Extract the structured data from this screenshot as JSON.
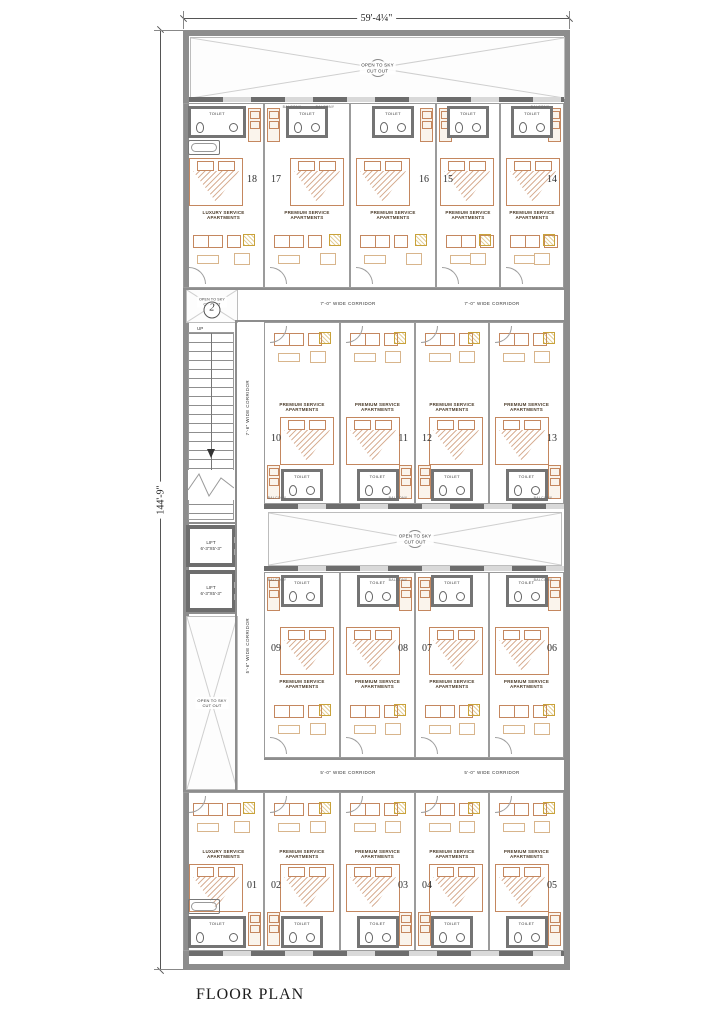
{
  "title": "FLOOR PLAN",
  "dimensions": {
    "width": "59'-4¼\"",
    "height": "144'-9\""
  },
  "labels": {
    "open_to_sky": "OPEN TO SKY",
    "cut_out": "CUT OUT",
    "toilet": "TOILET",
    "balcony": "BALCONY",
    "up": "UP",
    "lift": "LIFT",
    "lift_size": "6'-3\"X5'-3\"",
    "corridor_top": "7'-0\" WIDE CORRIDOR",
    "corridor_bottom": "5'-0\" WIDE CORRIDOR",
    "corridor_left_upper": "7'-6\" WIDE CORRIDOR",
    "corridor_left_lower": "5'-6\" WIDE CORRIDOR",
    "level_marker": "2"
  },
  "unit_types": {
    "premium": "PREMIUM SERVICE APARTMENTS",
    "luxury": "LUXURY SERVICE APARTMENTS"
  },
  "units": {
    "row1": [
      {
        "number": "18",
        "type": "luxury"
      },
      {
        "number": "17",
        "type": "premium"
      },
      {
        "number": "16",
        "type": "premium"
      },
      {
        "number": "15",
        "type": "premium"
      },
      {
        "number": "14",
        "type": "premium"
      }
    ],
    "row2": [
      {
        "number": "10",
        "type": "premium"
      },
      {
        "number": "11",
        "type": "premium"
      },
      {
        "number": "12",
        "type": "premium"
      },
      {
        "number": "13",
        "type": "premium"
      }
    ],
    "row3": [
      {
        "number": "09",
        "type": "premium"
      },
      {
        "number": "08",
        "type": "premium"
      },
      {
        "number": "07",
        "type": "premium"
      },
      {
        "number": "06",
        "type": "premium"
      }
    ],
    "row4": [
      {
        "number": "01",
        "type": "luxury"
      },
      {
        "number": "02",
        "type": "premium"
      },
      {
        "number": "03",
        "type": "premium"
      },
      {
        "number": "04",
        "type": "premium"
      },
      {
        "number": "05",
        "type": "premium"
      }
    ]
  },
  "colors": {
    "wall": "#8d8d8d",
    "wall_dark": "#6d6d6d",
    "line": "#9e9e9e",
    "furniture": "#c4875f",
    "accent": "#c9a23a",
    "text": "#3c3c3c",
    "dim": "#555555"
  }
}
